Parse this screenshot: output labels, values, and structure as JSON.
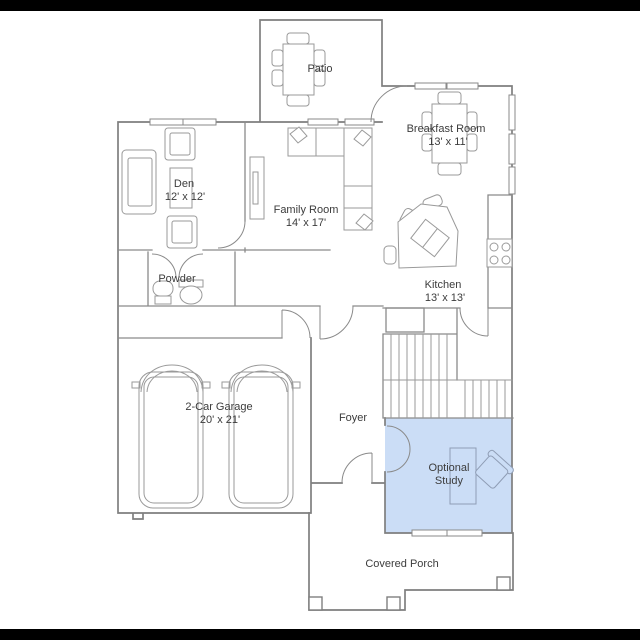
{
  "app": {
    "type": "residential-floor-plan",
    "letterbox_color": "#000000",
    "background": "#ffffff"
  },
  "palette": {
    "wall_line": "#7f7f7f",
    "furniture_line": "#9a9a9a",
    "text_color": "#3c3c3c",
    "highlight_fill": "#cbddf6"
  },
  "rooms": {
    "patio": {
      "label": "Patio"
    },
    "breakfast": {
      "label": "Breakfast Room",
      "dimensions": "13' x 11'"
    },
    "den": {
      "label": "Den",
      "dimensions": "12' x 12'"
    },
    "family": {
      "label": "Family Room",
      "dimensions": "14' x 17'"
    },
    "kitchen": {
      "label": "Kitchen",
      "dimensions": "13' x 13'"
    },
    "powder": {
      "label": "Powder"
    },
    "garage": {
      "label": "2-Car Garage",
      "dimensions": "20' x 21'"
    },
    "foyer": {
      "label": "Foyer"
    },
    "study": {
      "label_line1": "Optional",
      "label_line2": "Study",
      "highlighted": true
    },
    "porch": {
      "label": "Covered Porch"
    }
  }
}
